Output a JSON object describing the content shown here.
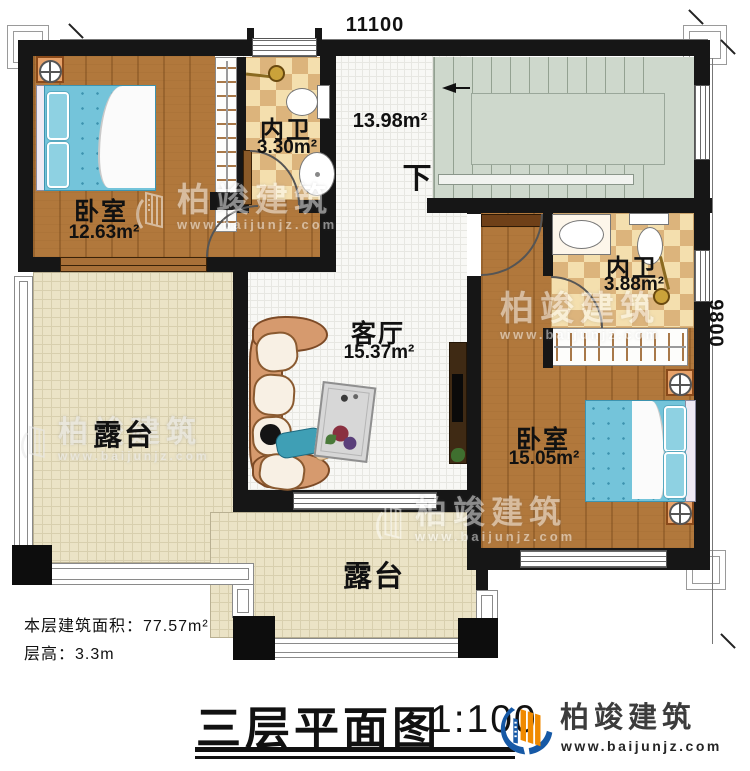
{
  "dimensions": {
    "top": "11100",
    "right": "9800"
  },
  "rooms": {
    "bedroom1": {
      "name": "卧室",
      "area": "12.63m²"
    },
    "bath1": {
      "name": "内卫",
      "area": "3.30m²"
    },
    "stair_hall": {
      "area": "13.98m²",
      "direction": "下"
    },
    "bath2": {
      "name": "内卫",
      "area": "3.88m²"
    },
    "bedroom2": {
      "name": "卧室",
      "area": "15.05m²"
    },
    "living": {
      "name": "客厅",
      "area": "15.37m²"
    },
    "terrace_left": {
      "name": "露台"
    },
    "terrace_front": {
      "name": "露台"
    }
  },
  "notes": {
    "floor_area": "本层建筑面积：77.57m²",
    "floor_height": "层高：3.3m"
  },
  "titleblock": {
    "title": "三层平面图",
    "scale": "1:100"
  },
  "brand": {
    "name": "柏竣建筑",
    "url": "www.baijunjz.com"
  },
  "watermark": {
    "name": "柏竣建筑",
    "url": "www.baijunjz.com"
  },
  "colors": {
    "wall": "#161616",
    "wood_floor": "#b1783c",
    "checker_tile": "#dcb47c",
    "stairs": "#ced8cc",
    "terrace": "#ebe3c6",
    "bed": "#74c4da",
    "logo_blue": "#1659a6",
    "logo_orange": "#f08a00"
  }
}
